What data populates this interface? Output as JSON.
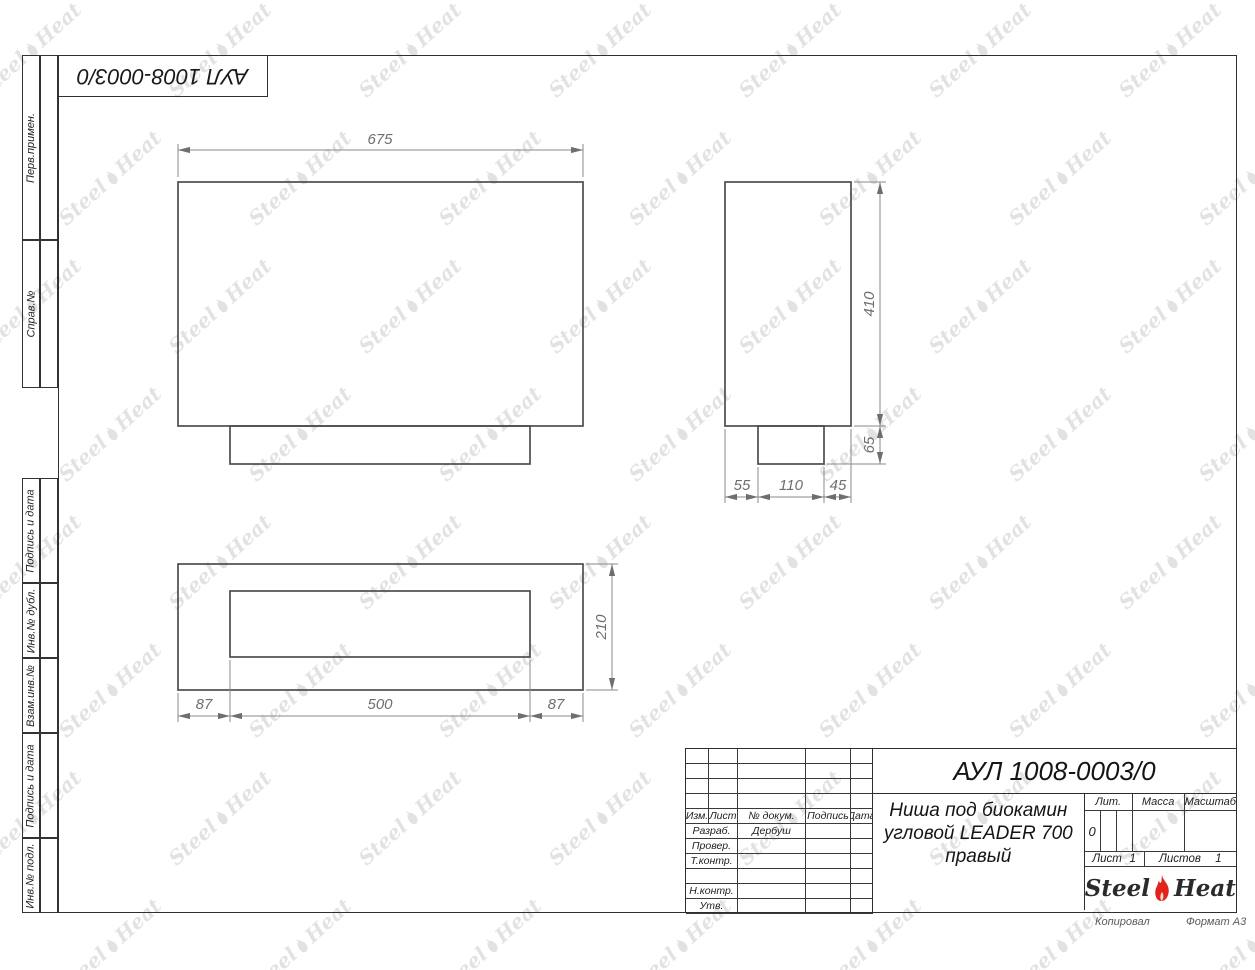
{
  "document": {
    "designation": "АУЛ 1008-0003/0",
    "name_lines": [
      "Ниша под биокамин",
      "угловой LEADER 700",
      "правый"
    ],
    "copied_label": "Копировал",
    "format_label": "Формат А3"
  },
  "side_strip": {
    "labels_top": [
      "Перв.примен.",
      "Справ.№"
    ],
    "labels_bottom": [
      "Подпись и дата",
      "Инв.№ дубл.",
      "Взам.инв.№",
      "Подпись и дата",
      "Инв.№ подл."
    ]
  },
  "title_block": {
    "header_cols": [
      "Изм.",
      "Лист",
      "№ докум.",
      "Подпись",
      "Дата"
    ],
    "approval_rows": [
      {
        "label": "Разраб.",
        "value": "Дербуш"
      },
      {
        "label": "Провер.",
        "value": ""
      },
      {
        "label": "Т.контр.",
        "value": ""
      },
      {
        "label": "",
        "value": ""
      },
      {
        "label": "Н.контр.",
        "value": ""
      },
      {
        "label": "Утв.",
        "value": ""
      }
    ],
    "lit_label": "Лит.",
    "lit_value": "0",
    "mass_label": "Масса",
    "scale_label": "Масштаб",
    "sheet_label": "Лист",
    "sheet_value": "1",
    "sheets_label": "Листов",
    "sheets_value": "1"
  },
  "logo": {
    "word1": "Steel",
    "word2": "Heat",
    "flame_color": "#e2231a"
  },
  "watermark": {
    "word1": "Steel",
    "word2": "Heat"
  },
  "drawing": {
    "front_view": {
      "width": "675"
    },
    "side_view": {
      "height": "410",
      "base_height": "65",
      "bottom_dims": [
        "55",
        "110",
        "45"
      ]
    },
    "plan_view": {
      "depth": "210",
      "bottom_dims": [
        "87",
        "500",
        "87"
      ]
    }
  }
}
